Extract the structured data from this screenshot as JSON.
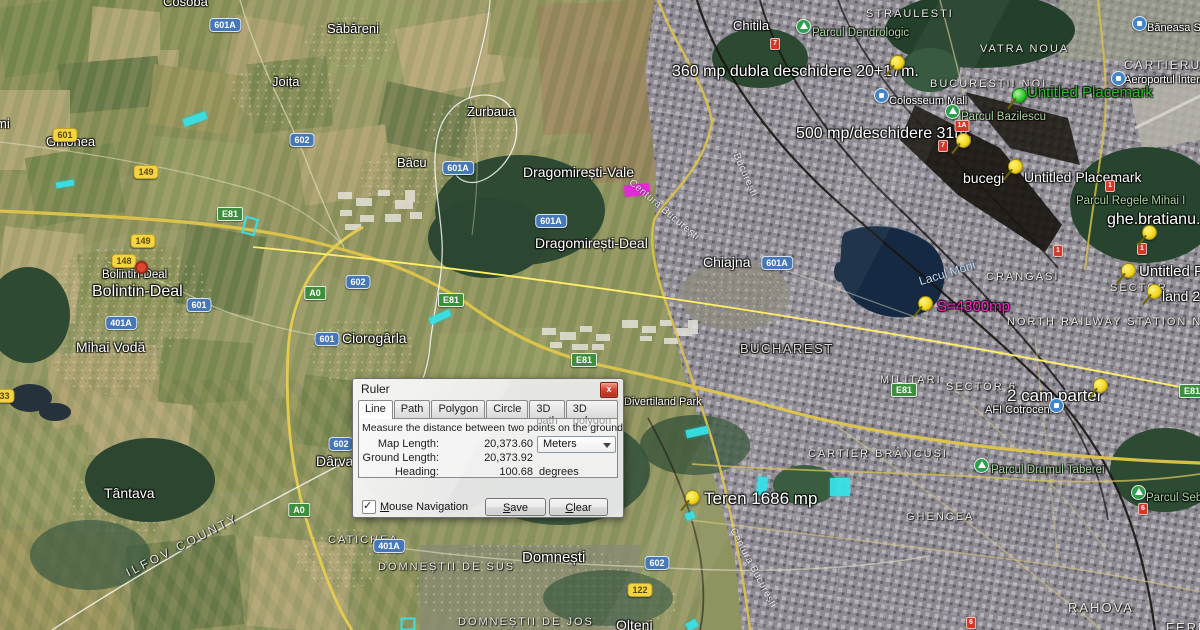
{
  "ruler_dialog": {
    "title": "Ruler",
    "close_glyph": "x",
    "tabs": [
      "Line",
      "Path",
      "Polygon",
      "Circle",
      "3D path",
      "3D polygon"
    ],
    "active_tab": "Line",
    "description": "Measure the distance between two points on the ground",
    "map_length_label": "Map Length:",
    "map_length_value": "20,373.60",
    "units_selected": "Meters",
    "ground_length_label": "Ground Length:",
    "ground_length_value": "20,373.92",
    "heading_label": "Heading:",
    "heading_value": "100.68",
    "heading_unit": "degrees",
    "mouse_nav_label": "Mouse Navigation",
    "mouse_nav_checked": true,
    "check_glyph": "✓",
    "save_label": "Save",
    "clear_label": "Clear"
  },
  "map": {
    "places": [
      {
        "text": "Cosoba"
      },
      {
        "text": "Săbăreni"
      },
      {
        "text": "Joița"
      },
      {
        "text": "Zurbaua"
      },
      {
        "text": "Bâcu"
      },
      {
        "text": "Dragomirești-Vale"
      },
      {
        "text": "Dragomirești-Deal"
      },
      {
        "text": "Ghionea"
      },
      {
        "text": "Bolintin-Deal"
      },
      {
        "text": "Bolintin-Deal"
      },
      {
        "text": "Mihai Vodă"
      },
      {
        "text": "Ciorogârla"
      },
      {
        "text": "Chiajna"
      },
      {
        "text": "Tântava"
      },
      {
        "text": "Dârvari"
      },
      {
        "text": "Domnești"
      },
      {
        "text": "Olteni"
      },
      {
        "text": "Chitila"
      },
      {
        "text": "mi"
      }
    ],
    "areas": [
      {
        "text": "STRAULESTI"
      },
      {
        "text": "VATRA NOUA"
      },
      {
        "text": "BUCURESTII NOI"
      },
      {
        "text": "CARTIERUL HE"
      },
      {
        "text": "CRANGASI"
      },
      {
        "text": "SECTOR"
      },
      {
        "text": "NORTH RAILWAY STATION NEIGH"
      },
      {
        "text": "MILITARI"
      },
      {
        "text": "SECTOR 6"
      },
      {
        "text": "CARTIER BRÂNCUȘI"
      },
      {
        "text": "GHENCEA"
      },
      {
        "text": "RAHOVA"
      },
      {
        "text": "FERE"
      },
      {
        "text": "DOMNEȘTII DE SUS"
      },
      {
        "text": "DOMNEȘTII DE JOS"
      },
      {
        "text": "CATICHEA"
      },
      {
        "text": "ILFOV COUNTY"
      },
      {
        "text": "BUCHAREST"
      }
    ],
    "parks": [
      {
        "text": "Parcul Dendrologic"
      },
      {
        "text": "Parcul Bazilescu"
      },
      {
        "text": "Parcul  Regele Mihai I"
      },
      {
        "text": "Parcul Drumul Taberei"
      },
      {
        "text": "Parcul Seba"
      }
    ],
    "pois": [
      {
        "text": "Colosseum Mall"
      },
      {
        "text": "Băneasa Sh"
      },
      {
        "text": "Aeroportul Interna"
      },
      {
        "text": "AFI Cotroceni"
      },
      {
        "text": "Divertiland Park"
      }
    ],
    "annotations": [
      {
        "text": "360 mp dubla deschidere 20+17m."
      },
      {
        "text": "500 mp/deschidere 31m."
      },
      {
        "text": "bucegi"
      },
      {
        "text": "Untitled Placemark"
      },
      {
        "text": "Untitled Placemark"
      },
      {
        "text": "ghe.bratianu."
      },
      {
        "text": "Untitled P"
      },
      {
        "text": "land 2"
      },
      {
        "text": "S=4300mp"
      },
      {
        "text": "2 cam parter"
      },
      {
        "text": "Teren 1686 mp"
      },
      {
        "text": "Lacul Morii"
      }
    ],
    "road_labels": [
      {
        "text": "Centura București"
      },
      {
        "text": "București"
      },
      {
        "text": "Centura București"
      }
    ],
    "shields": [
      {
        "type": "blue",
        "text": "601A"
      },
      {
        "type": "blue",
        "text": "602"
      },
      {
        "type": "blue",
        "text": "601A"
      },
      {
        "type": "blue",
        "text": "601A"
      },
      {
        "type": "blue",
        "text": "601"
      },
      {
        "type": "blue",
        "text": "401A"
      },
      {
        "type": "blue",
        "text": "602"
      },
      {
        "type": "blue",
        "text": "601"
      },
      {
        "type": "blue",
        "text": "601A"
      },
      {
        "type": "blue",
        "text": "602"
      },
      {
        "type": "blue",
        "text": "401A"
      },
      {
        "type": "blue",
        "text": "602"
      },
      {
        "type": "yellow",
        "text": "601"
      },
      {
        "type": "yellow",
        "text": "149"
      },
      {
        "type": "yellow",
        "text": "149"
      },
      {
        "type": "yellow",
        "text": "148"
      },
      {
        "type": "yellow",
        "text": "133"
      },
      {
        "type": "yellow",
        "text": "122"
      },
      {
        "type": "green",
        "text": "E81"
      },
      {
        "type": "green",
        "text": "A0"
      },
      {
        "type": "green",
        "text": "E81"
      },
      {
        "type": "green",
        "text": "E81"
      },
      {
        "type": "green",
        "text": "A0"
      },
      {
        "type": "green",
        "text": "E81"
      },
      {
        "type": "green",
        "text": "E81"
      },
      {
        "type": "red",
        "text": "7"
      },
      {
        "type": "red",
        "text": "1A"
      },
      {
        "type": "red",
        "text": "7"
      },
      {
        "type": "red",
        "text": "1"
      },
      {
        "type": "red",
        "text": "1"
      },
      {
        "type": "red",
        "text": "1"
      },
      {
        "type": "red",
        "text": "6"
      },
      {
        "type": "red",
        "text": "6"
      }
    ],
    "colors": {
      "pushpin_yellow": "#f3d824",
      "pushpin_green": "#2ecb2e",
      "annotation_green": "#21c421",
      "annotation_magenta": "#ff22cc",
      "drawn_cyan": "#37e2e8",
      "drawn_magenta": "#e428d8",
      "road_yellow": "#dfc64a",
      "ruler_line_yellow": "#ffee66",
      "lake_navy": "#152a42"
    }
  }
}
